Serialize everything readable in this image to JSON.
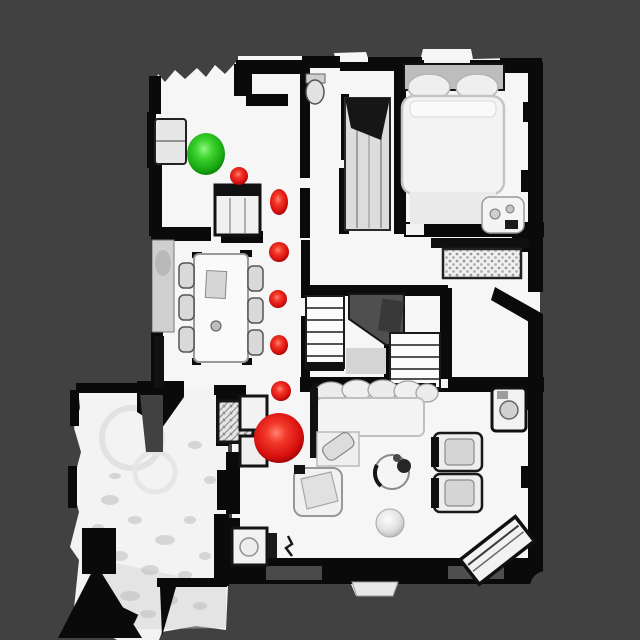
{
  "scene": {
    "description": "top-down rendered 3D scan of a house interior with navigation markers",
    "background_color": "#414141",
    "floor_color": "#f5f5f5",
    "wall_color": "#0a0a0a",
    "stairwell_color": "#4f4f4f"
  },
  "markers": {
    "start": {
      "label": "start-point",
      "color": "#2ecc1e",
      "x": 206,
      "y": 154,
      "rx": 19,
      "ry": 21
    },
    "goal": {
      "label": "goal-point",
      "color": "#d90f0f",
      "x": 279,
      "y": 438,
      "rx": 25,
      "ry": 25
    },
    "waypoints": {
      "color": "#d90f0f",
      "points": [
        {
          "x": 239,
          "y": 176,
          "rx": 9,
          "ry": 9
        },
        {
          "x": 279,
          "y": 202,
          "rx": 9,
          "ry": 13
        },
        {
          "x": 279,
          "y": 252,
          "rx": 10,
          "ry": 10
        },
        {
          "x": 278,
          "y": 299,
          "rx": 9,
          "ry": 9
        },
        {
          "x": 279,
          "y": 345,
          "rx": 9,
          "ry": 10
        },
        {
          "x": 281,
          "y": 391,
          "rx": 10,
          "ry": 10
        }
      ]
    }
  }
}
